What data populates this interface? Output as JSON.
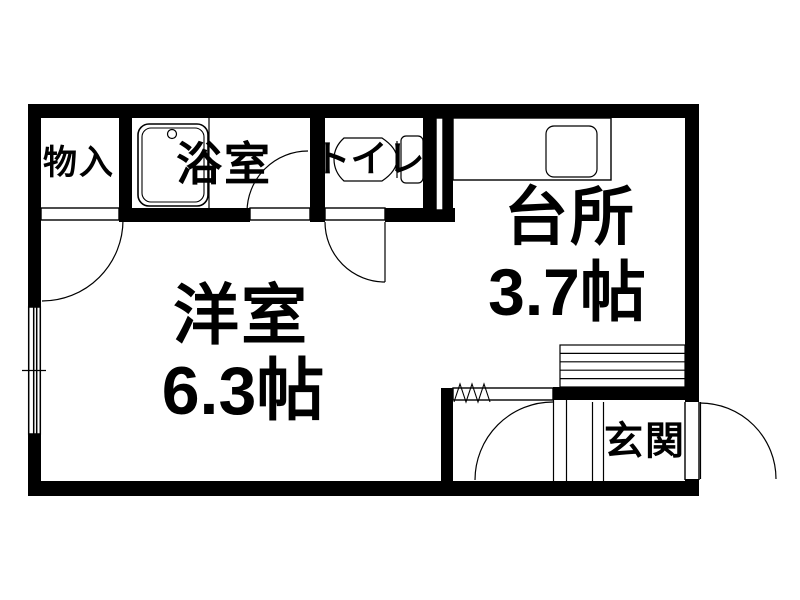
{
  "meta": {
    "drawing_type": "apartment floor plan",
    "background_color": "#ffffff",
    "wall_color": "#000000",
    "line_color": "#000000"
  },
  "rooms": {
    "western_room": {
      "name": "洋室",
      "size": "6.3帖"
    },
    "kitchen": {
      "name": "台所",
      "size": "3.7帖"
    },
    "closet": {
      "name": "物入"
    },
    "bathroom": {
      "name": "浴室"
    },
    "toilet": {
      "name": "トイレ"
    },
    "entrance": {
      "name": "玄関"
    }
  },
  "fixtures": {
    "bathtub": "bathtub-icon",
    "bathtub_faucet": "faucet-dot-icon",
    "toilet": "toilet-icon",
    "kitchen_counter": "counter-icon",
    "sink": "sink-icon",
    "shoe_cabinet": "shoe-cabinet-icon",
    "window": "window-symbol",
    "door_arcs": "door-swing-arc",
    "folding_partition": "zigzag-symbol"
  }
}
